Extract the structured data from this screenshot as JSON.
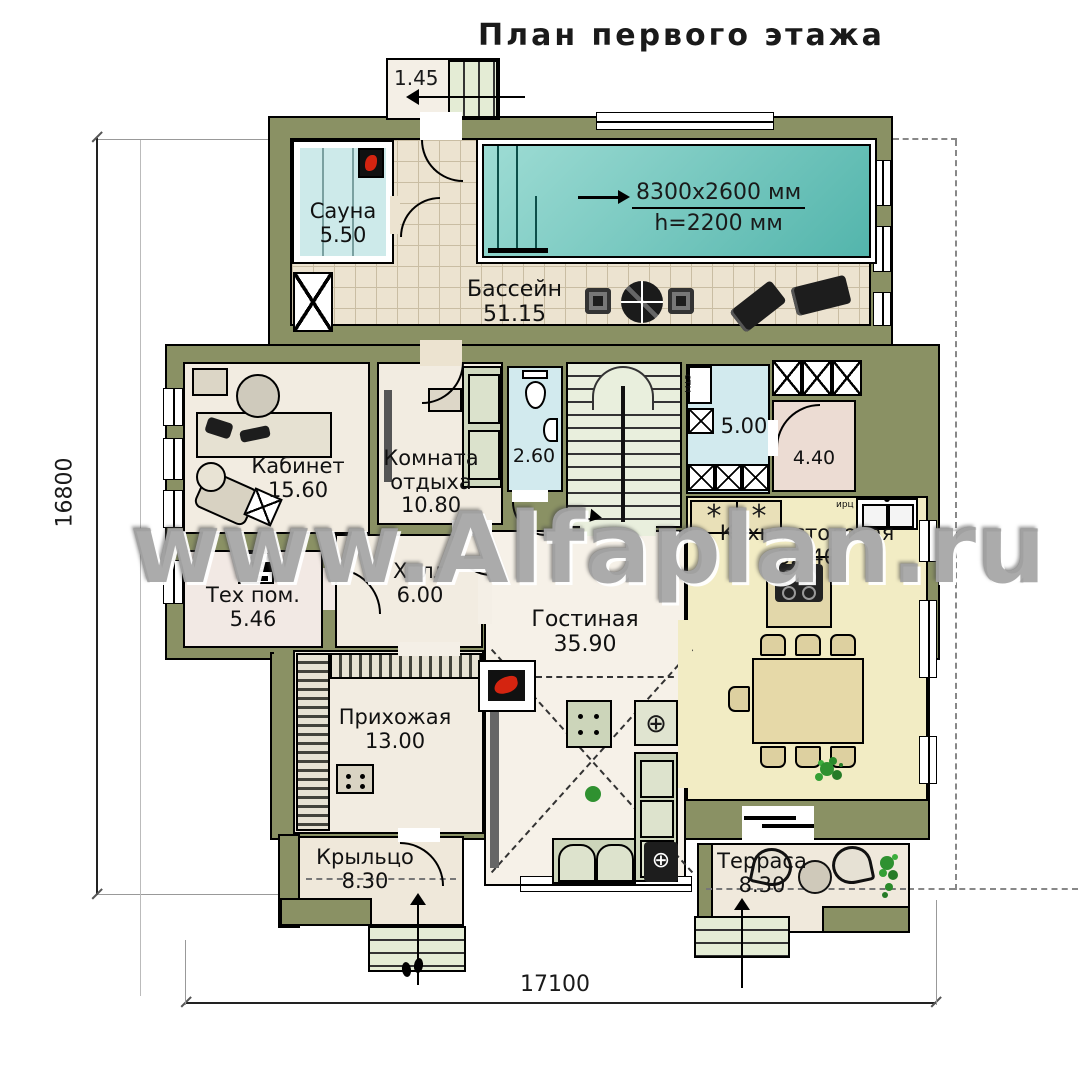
{
  "title": "План первого этажа",
  "watermark": "www.Alfaplan.ru",
  "dims": {
    "left": "16800",
    "bottom": "17100",
    "top_porch": "1.45"
  },
  "pool_note": {
    "line1": "8300х2600 мм",
    "line2": "h=2200 мм"
  },
  "rooms": {
    "sauna": {
      "name": "Сауна",
      "area": "5.50"
    },
    "pool": {
      "name": "Бассейн",
      "area": "51.15"
    },
    "study": {
      "name": "Кабинет",
      "area": "15.60"
    },
    "lounge": {
      "name": "Комната отдыха",
      "area": "10.80"
    },
    "wc": {
      "area": "2.60"
    },
    "laundry": {
      "area": "5.00"
    },
    "pantry": {
      "area": "4.40"
    },
    "kitchen": {
      "name": "Кухня-столовая",
      "area": "32.40"
    },
    "tech": {
      "name": "Тех пом.",
      "area": "5.46"
    },
    "hall": {
      "name": "Холл",
      "area": "6.00"
    },
    "living": {
      "name": "Гостиная",
      "area": "35.90"
    },
    "entry": {
      "name": "Прихожая",
      "area": "13.00"
    },
    "porch": {
      "name": "Крыльцо",
      "area": "8.30"
    },
    "terrace": {
      "name": "Терраса",
      "area": "8.30"
    }
  },
  "small_labels": {
    "washer": "стм",
    "boiler": "оке",
    "kitchen_unit": "ирц"
  },
  "colors": {
    "wall": "#8a9164",
    "floor": "#f2ece1",
    "water": "#6cc4bb",
    "wet": "#d2eaee",
    "kitchen_floor": "#f2ecc4",
    "steps": "#e4ecd5"
  }
}
